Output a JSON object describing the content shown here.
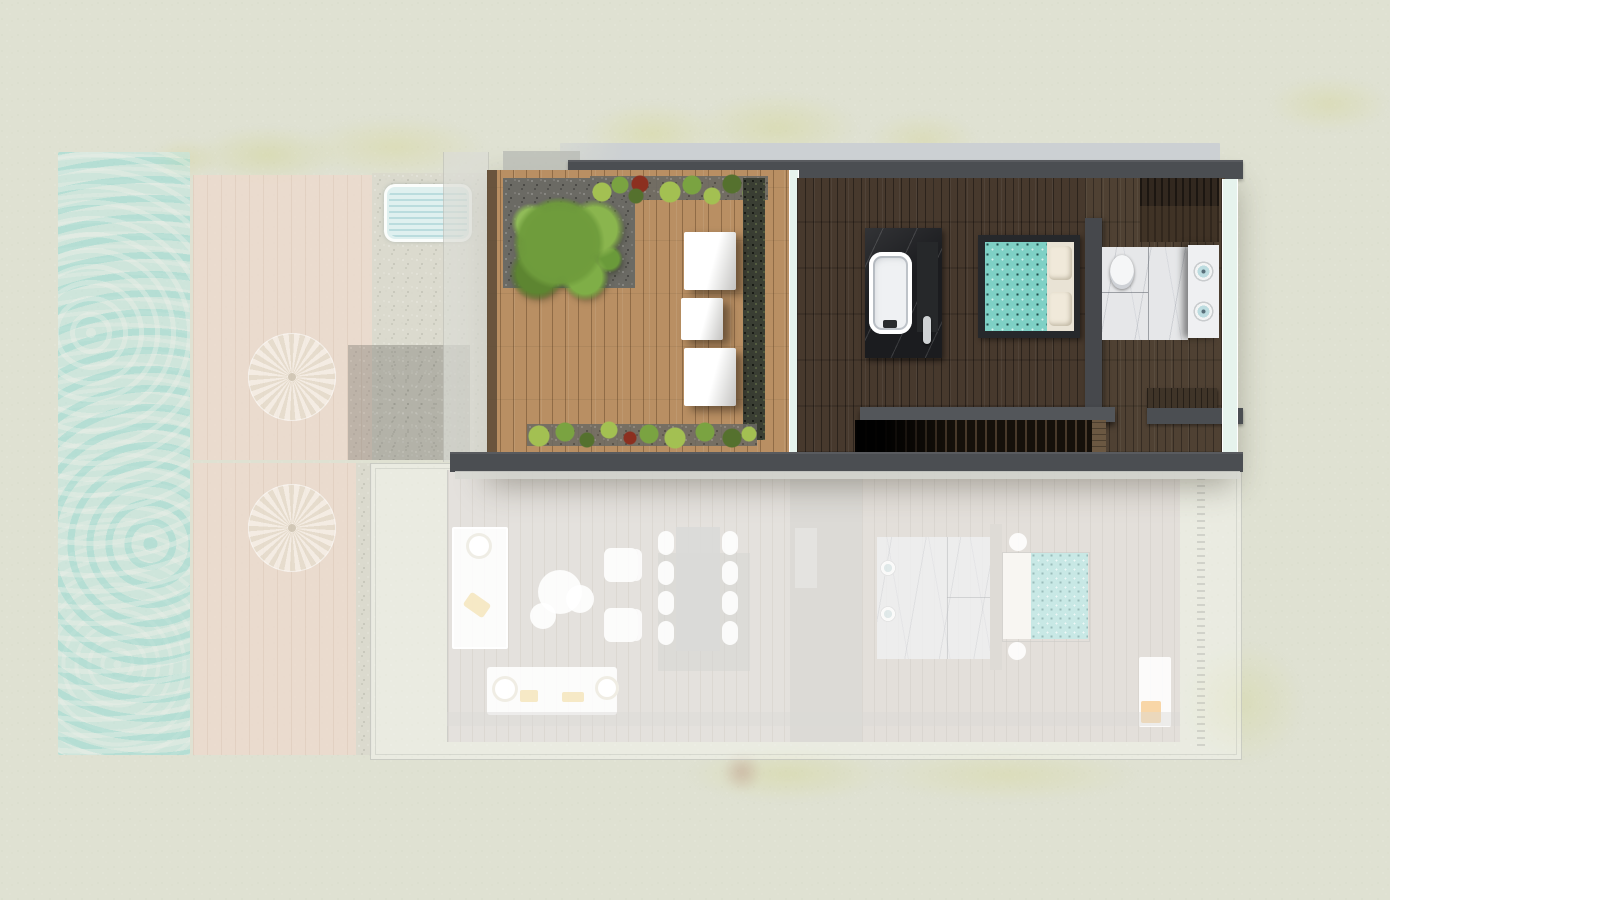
{
  "view": {
    "type": "floor-plan",
    "active_level": "upper",
    "ghost_level": "lower"
  },
  "palette": {
    "bg": "#dfe1d2",
    "white_panel": "#ffffff",
    "wall": "#4b4e52",
    "roof_band": "#ccd0d3",
    "deck": "#b98f63",
    "deck_edge": "#5c4a36",
    "ghost_deck": "#eedacd",
    "patio": "#e7e3da",
    "pool": "#bfe9e5",
    "plunge": "#dff0ef",
    "glass": "#e6f3ed",
    "wood_dark": "#47392d",
    "wardrobe": "#32281f",
    "stone": "#1b1c1f",
    "tub_white": "#eff1f3",
    "bed_frame": "#26282b",
    "teal": "#7ed0c5",
    "teal_ghost": "#abdcd8",
    "pillow": "#f0e9da",
    "marble": "#e6e7e9",
    "vanity": "#eff0f2",
    "sink_bowl": "#bcdce0",
    "hedge": "#3a3e33",
    "gravel_dark": "#6b6a64",
    "green1": "#7aa341",
    "green2": "#a3c052",
    "green3": "#55712e",
    "red_plant": "#8c3020",
    "guard": "#53565a",
    "bench_wood": "#3f3428",
    "ghost_floor": "#d6d2cb",
    "ghost_stair": "#c9c6c1",
    "ghost_bedroom": "#d4cec6",
    "table_grey": "#c6c6c4",
    "rug": "#bebeba",
    "towel": "#f3b761",
    "yellow_throw": "#f0d79a",
    "shrub_faded": "#d6d6a0",
    "slab": "#d7d8d2"
  },
  "site": {
    "features": [
      "pool",
      "sun-deck-upper",
      "sun-deck-lower",
      "parasols",
      "plunge-pool",
      "gravel-path",
      "lawn",
      "faded-shrubs"
    ],
    "parasol_count": 2
  },
  "upper_floor": {
    "rooms": [
      "roof-terrace",
      "master-suite"
    ],
    "terrace": {
      "lounger_count": 3,
      "features": [
        "shrub",
        "planted-border-top",
        "planted-border-bottom",
        "privacy-hedge",
        "gravel-bed"
      ]
    },
    "master_suite": {
      "features": [
        "bathtub",
        "stone-platform",
        "double-bed",
        "headboard-partition",
        "toilet",
        "marble-bathroom",
        "vanity",
        "wardrobe",
        "staircase",
        "stair-guard-wall",
        "glass-wall"
      ],
      "sink_count": 2,
      "pillow_count": 2
    }
  },
  "lower_floor": {
    "rooms": [
      "living-dining",
      "bedroom"
    ],
    "living_dining": {
      "features": [
        "chaise",
        "coffee-table-set",
        "armchairs",
        "dining-table",
        "dining-chairs",
        "sofa",
        "side-tables"
      ],
      "dining_chair_count": 8,
      "armchair_count": 2,
      "coffee_table_count": 3
    },
    "bedroom": {
      "features": [
        "double-bed",
        "bedside-tables",
        "marble-bathroom",
        "sinks",
        "headboard-partition",
        "lounger-mat",
        "towel",
        "trellis-edge"
      ],
      "sink_count": 2,
      "bedside_table_count": 2
    }
  }
}
